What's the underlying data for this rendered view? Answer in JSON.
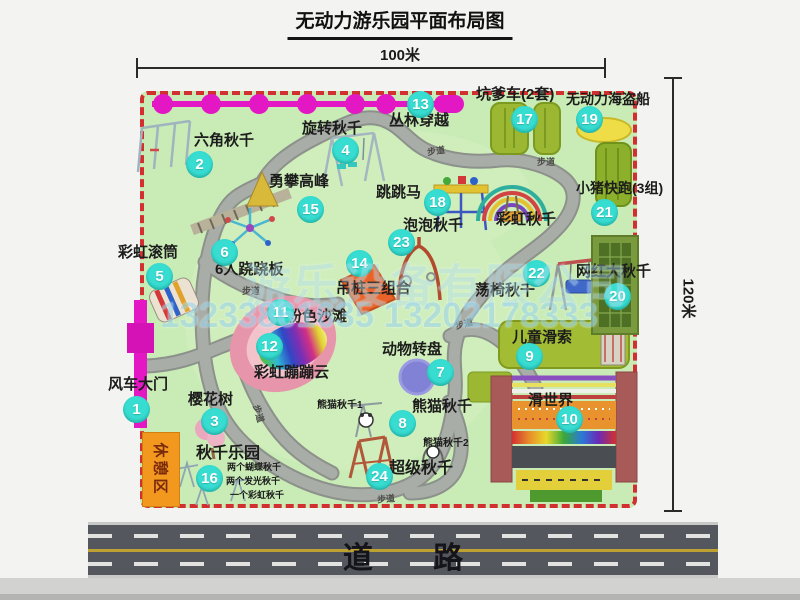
{
  "title": "无动力游乐园平面布局图",
  "dimensions": {
    "width": "100米",
    "height": "120米"
  },
  "road_label": "道 路",
  "rest_area_label": "休憩区",
  "trail_label": "步道",
  "watermark": {
    "company": "游乐设备有限公司",
    "phone": "13233861635 13202178333"
  },
  "attractions": [
    {
      "num": "1",
      "name": "风车大门"
    },
    {
      "num": "2",
      "name": "六角秋千"
    },
    {
      "num": "3",
      "name": "樱花树"
    },
    {
      "num": "4",
      "name": "旋转秋千"
    },
    {
      "num": "5",
      "name": "彩虹滚筒"
    },
    {
      "num": "6",
      "name": "6人跷跷板"
    },
    {
      "num": "7",
      "name": "动物转盘"
    },
    {
      "num": "8",
      "name": "熊猫秋千"
    },
    {
      "num": "9",
      "name": "儿童滑索"
    },
    {
      "num": "10",
      "name": "滑世界"
    },
    {
      "num": "11",
      "name": "粉色沙滩"
    },
    {
      "num": "12",
      "name": "彩虹蹦蹦云"
    },
    {
      "num": "13",
      "name": "丛林穿越"
    },
    {
      "num": "14",
      "name": "吊桩三组合"
    },
    {
      "num": "15",
      "name": "勇攀高峰"
    },
    {
      "num": "16",
      "name": "秋千乐园",
      "details": [
        "两个蝴蝶秋千",
        "两个发光秋千",
        "一个彩虹秋千"
      ]
    },
    {
      "num": "17",
      "name": "坑爹车(2套)"
    },
    {
      "num": "18",
      "name": "跳跳马"
    },
    {
      "num": "19",
      "name": "无动力海盗船"
    },
    {
      "num": "20",
      "name": "网红大秋千"
    },
    {
      "num": "21",
      "name": "小猪快跑(3组)"
    },
    {
      "num": "22",
      "name": "荡椅秋千"
    },
    {
      "num": "23",
      "name": "泡泡秋千"
    },
    {
      "num": "24",
      "name": "超级秋千"
    }
  ],
  "unnumbered_labels": {
    "rainbow_swing": "彩虹秋千",
    "panda_swing_1": "熊猫秋千1",
    "panda_swing_2": "熊猫秋千2"
  },
  "colors": {
    "map_green": "#c9ecb6",
    "dashed_border_red": "#d23030",
    "badge_teal": "#38ddd2",
    "cable_magenta": "#e318c4",
    "rest_area_orange": "#f2981e",
    "road_gray": "#54585e",
    "watermark_blue": "#a9ddf0"
  }
}
